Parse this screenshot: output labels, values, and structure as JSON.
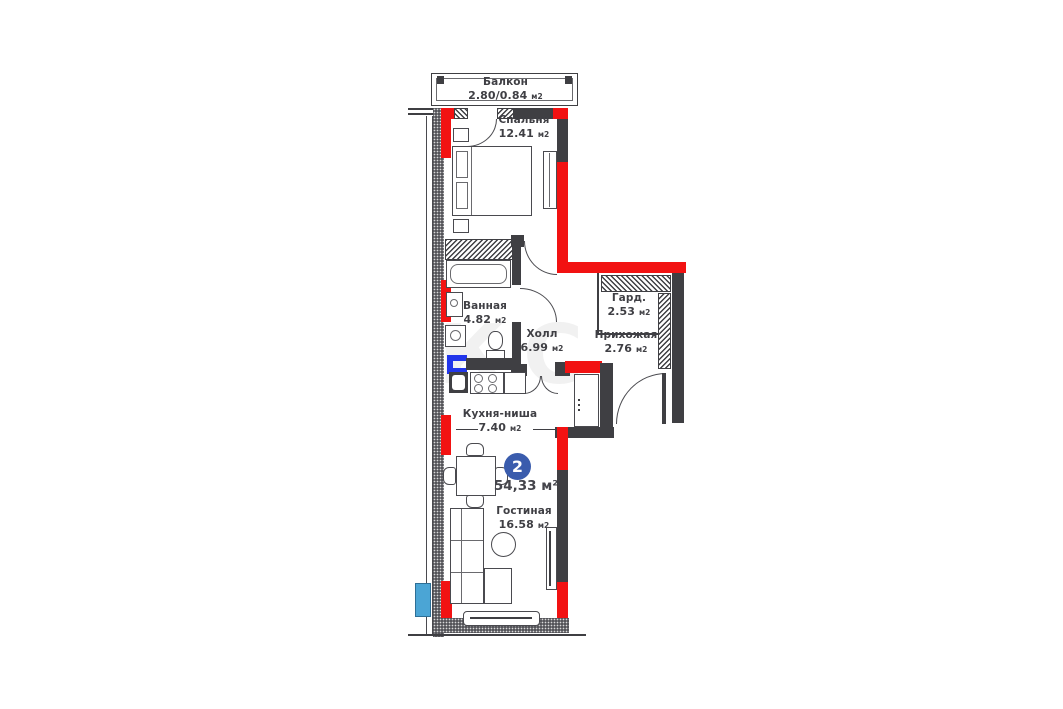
{
  "plan": {
    "badge": {
      "number": "2",
      "area_value": "54,33",
      "area_unit": "м²"
    },
    "rooms": [
      {
        "id": "balcony",
        "name": "Балкон",
        "area_value": "2.80/0.84",
        "area_unit": "м2"
      },
      {
        "id": "bedroom",
        "name": "Спальня",
        "area_value": "12.41",
        "area_unit": "м2"
      },
      {
        "id": "bathroom",
        "name": "Ванная",
        "area_value": "4.82",
        "area_unit": "м2"
      },
      {
        "id": "hall",
        "name": "Холл",
        "area_value": "6.99",
        "area_unit": "м2"
      },
      {
        "id": "wardrobe",
        "name": "Гард.",
        "area_value": "2.53",
        "area_unit": "м2"
      },
      {
        "id": "entry",
        "name": "Прихожая",
        "area_value": "2.76",
        "area_unit": "м2"
      },
      {
        "id": "kitchen",
        "name": "Кухня-ниша",
        "area_value": "7.40",
        "area_unit": "м2"
      },
      {
        "id": "living",
        "name": "Гостиная",
        "area_value": "16.58",
        "area_unit": "м2"
      }
    ],
    "colors": {
      "wall_dark": "#3f3f43",
      "wall_red": "#f21212",
      "badge_blue": "#3a5cad",
      "pipe_blue": "#2135ea",
      "exterior_blue": "#4ba5d5",
      "label_text": "#3f3f44"
    },
    "watermark": "КС"
  }
}
